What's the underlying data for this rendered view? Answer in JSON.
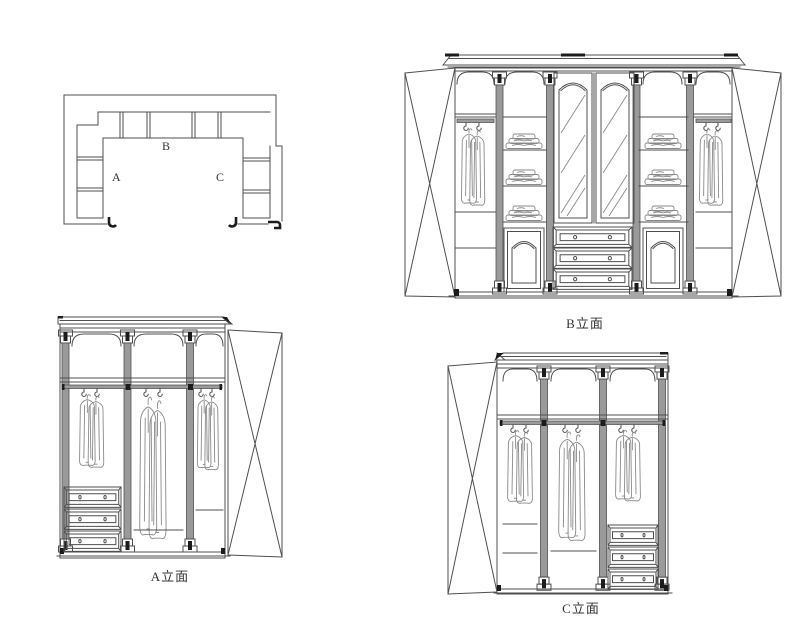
{
  "colors": {
    "background": "#ffffff",
    "line": "#4f4f4f",
    "line_light": "#8a8a8a",
    "gray_fill": "#9a9a9a",
    "dark": "#1c1c1c",
    "text": "#333333"
  },
  "plan": {
    "label_a": "A",
    "label_b": "B",
    "label_c": "C"
  },
  "elevations": {
    "a": {
      "label": "A立面"
    },
    "b": {
      "label": "B立面"
    },
    "c": {
      "label": "C立面"
    }
  }
}
